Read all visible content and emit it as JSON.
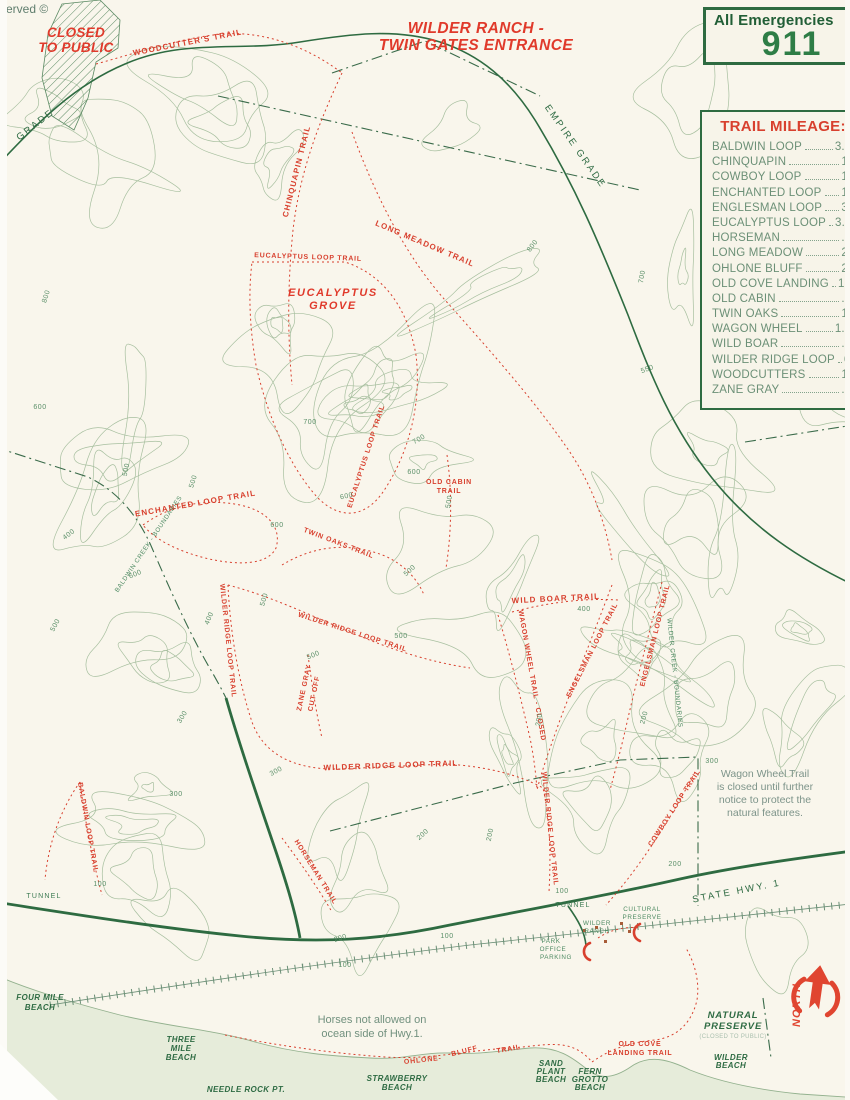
{
  "page": {
    "reserved": "served ©"
  },
  "title": {
    "line1": "WILDER RANCH -",
    "line2": "TWIN GATES ENTRANCE"
  },
  "closed_area": {
    "line1": "CLOSED",
    "line2": "TO PUBLIC"
  },
  "emergency": {
    "label": "All Emergencies",
    "number": "911"
  },
  "mileage": {
    "title": "TRAIL MILEAGE:",
    "entries": [
      {
        "name": "BALDWIN LOOP",
        "miles": "3.25"
      },
      {
        "name": "CHINQUAPIN",
        "miles": "1.2"
      },
      {
        "name": "COWBOY LOOP",
        "miles": "1.5"
      },
      {
        "name": "ENCHANTED LOOP",
        "miles": "1.5"
      },
      {
        "name": "ENGLESMAN LOOP",
        "miles": "3.0"
      },
      {
        "name": "EUCALYPTUS LOOP",
        "miles": "3.75"
      },
      {
        "name": "HORSEMAN",
        "miles": ".65"
      },
      {
        "name": "LONG MEADOW",
        "miles": "2.1"
      },
      {
        "name": "OHLONE BLUFF",
        "miles": "2.5"
      },
      {
        "name": "OLD COVE LANDING",
        "miles": "1.25"
      },
      {
        "name": "OLD CABIN",
        "miles": ".75"
      },
      {
        "name": "TWIN OAKS",
        "miles": "1.0"
      },
      {
        "name": "WAGON WHEEL",
        "miles": "1.75"
      },
      {
        "name": "WILD BOAR",
        "miles": ".25"
      },
      {
        "name": "WILDER RIDGE LOOP",
        "miles": "6.23"
      },
      {
        "name": "WOODCUTTERS",
        "miles": "1.9"
      },
      {
        "name": "ZANE GRAY",
        "miles": ".75"
      }
    ]
  },
  "notices": {
    "wagon": [
      "Wagon Wheel Trail",
      "is closed until further",
      "notice to protect the",
      "natural features."
    ],
    "horses": [
      "Horses not allowed on",
      "ocean side of Hwy.1."
    ]
  },
  "north_label": "NORTH",
  "colors": {
    "paper": "#f9f6ec",
    "ocean": "#e6ecda",
    "map_green": "#2e6b41",
    "trail_red": "#d8402e",
    "contour_green": "#a7bf9f",
    "mileage_text": "#6c9077"
  },
  "map": {
    "contours": {
      "seed": 11,
      "count": 58,
      "color": "#a7bf9f"
    },
    "labels": [
      {
        "t": "WOODCUTTER'S TRAIL",
        "x": 188,
        "y": 45,
        "r": -11,
        "c": "rt",
        "n": "label-woodcutters-trail"
      },
      {
        "t": "CHINQUAPIN TRAIL",
        "x": 299,
        "y": 172,
        "r": -76,
        "c": "rt",
        "n": "label-chinquapin-trail"
      },
      {
        "t": "LONG MEADOW TRAIL",
        "x": 424,
        "y": 246,
        "r": 23,
        "c": "rt",
        "n": "label-long-meadow-trail"
      },
      {
        "t": "EUCALYPTUS LOOP TRAIL",
        "x": 308,
        "y": 259,
        "r": 2,
        "c": "rt7",
        "n": "label-eucalyptus-loop-trail"
      },
      {
        "t": "EUCALYPTUS LOOP TRAIL",
        "x": 368,
        "y": 457,
        "r": -72,
        "c": "rt7",
        "n": "label-eucalyptus-loop-trail"
      },
      {
        "t": "OLD CABIN",
        "x": 449,
        "y": 484,
        "r": 0,
        "c": "rt7",
        "n": "label-old-cabin-trail"
      },
      {
        "t": "TRAIL",
        "x": 449,
        "y": 493,
        "r": 0,
        "c": "rt7",
        "n": "label-old-cabin-trail"
      },
      {
        "t": "ENCHANTED LOOP TRAIL",
        "x": 196,
        "y": 506,
        "r": -10,
        "c": "rt",
        "n": "label-enchanted-loop-trail"
      },
      {
        "t": "TWIN OAKS TRAIL",
        "x": 338,
        "y": 545,
        "r": 21,
        "c": "rt7",
        "n": "label-twin-oaks-trail"
      },
      {
        "t": "WILD BOAR TRAIL",
        "x": 556,
        "y": 601,
        "r": -3,
        "c": "rt",
        "n": "label-wild-boar-trail"
      },
      {
        "t": "WILDER RIDGE LOOP TRAIL",
        "x": 226,
        "y": 641,
        "r": 84,
        "c": "rt7",
        "n": "label-wilder-ridge-loop-trail"
      },
      {
        "t": "WILDER RIDGE LOOP TRAIL",
        "x": 352,
        "y": 634,
        "r": 18,
        "c": "rt7",
        "n": "label-wilder-ridge-loop-trail"
      },
      {
        "t": "ZANE GRAY",
        "x": 306,
        "y": 688,
        "r": -78,
        "c": "rt7",
        "n": "label-zane-gray-cutoff"
      },
      {
        "t": "CUT OFF",
        "x": 316,
        "y": 694,
        "r": -78,
        "c": "rt7",
        "n": "label-zane-gray-cutoff"
      },
      {
        "t": "WAGON WHEEL TRAIL - CLOSED",
        "x": 530,
        "y": 676,
        "r": 80,
        "c": "rt7",
        "n": "label-wagon-wheel-trail"
      },
      {
        "t": "ENGELSMAN LOOP TRAIL",
        "x": 594,
        "y": 651,
        "r": -63,
        "c": "rt7",
        "n": "label-engelsman-loop-trail"
      },
      {
        "t": "ENGELSMAN LOOP TRAIL",
        "x": 657,
        "y": 636,
        "r": -76,
        "c": "rt7",
        "n": "label-engelsman-loop-trail"
      },
      {
        "t": "WILDER RIDGE LOOP TRAIL",
        "x": 391,
        "y": 768,
        "r": -2,
        "c": "rt",
        "n": "label-wilder-ridge-loop-trail"
      },
      {
        "t": "WILDER RIDGE LOOP TRAIL",
        "x": 548,
        "y": 829,
        "r": 84,
        "c": "rt7",
        "n": "label-wilder-ridge-loop-trail"
      },
      {
        "t": "HORSEMAN TRAIL",
        "x": 314,
        "y": 873,
        "r": 58,
        "c": "rt7",
        "n": "label-horseman-trail"
      },
      {
        "t": "BALDWIN LOOP TRAIL",
        "x": 86,
        "y": 828,
        "r": 80,
        "c": "rt7",
        "n": "label-baldwin-loop-trail"
      },
      {
        "t": "COWBOY LOOP TRAIL",
        "x": 676,
        "y": 809,
        "r": -57,
        "c": "rt7",
        "n": "label-cowboy-loop-trail"
      },
      {
        "t": "OHLONE-",
        "x": 423,
        "y": 1062,
        "r": -6,
        "c": "rt7",
        "n": "label-ohlone-bluff-trail"
      },
      {
        "t": "BLUFF",
        "x": 465,
        "y": 1053,
        "r": -14,
        "c": "rt7",
        "n": "label-ohlone-bluff-trail"
      },
      {
        "t": "TRAIL",
        "x": 509,
        "y": 1051,
        "r": -10,
        "c": "rt7",
        "n": "label-ohlone-bluff-trail"
      },
      {
        "t": "OLD COVE",
        "x": 640,
        "y": 1046,
        "r": 0,
        "c": "rt7",
        "n": "label-old-cove-landing-trail"
      },
      {
        "t": "LANDING TRAIL",
        "x": 640,
        "y": 1055,
        "r": 0,
        "c": "rt7",
        "n": "label-old-cove-landing-trail"
      },
      {
        "t": "EUCALYPTUS",
        "x": 333,
        "y": 296,
        "r": 0,
        "c": "rg",
        "n": "label-eucalyptus-grove"
      },
      {
        "t": "GROVE",
        "x": 333,
        "y": 309,
        "r": 0,
        "c": "rg",
        "n": "label-eucalyptus-grove"
      },
      {
        "t": "GRADE",
        "x": 37,
        "y": 127,
        "r": -38,
        "c": "gl",
        "n": "label-grade-road"
      },
      {
        "t": "EMPIRE GRADE",
        "x": 573,
        "y": 148,
        "r": 55,
        "c": "gl",
        "n": "label-empire-grade-road"
      },
      {
        "t": "STATE HWY. 1",
        "x": 737,
        "y": 894,
        "r": -11,
        "c": "gl",
        "n": "label-state-hwy-1"
      },
      {
        "t": "TUNNEL",
        "x": 44,
        "y": 898,
        "r": 0,
        "c": "gs",
        "n": "label-tunnel"
      },
      {
        "t": "TUNNEL",
        "x": 573,
        "y": 907,
        "r": 0,
        "c": "gs",
        "n": "label-tunnel"
      },
      {
        "t": "WILDER",
        "x": 597,
        "y": 925,
        "r": 0,
        "c": "gs6",
        "n": "label-wilder-ranch"
      },
      {
        "t": "RANCH",
        "x": 597,
        "y": 933,
        "r": 0,
        "c": "gs6",
        "n": "label-wilder-ranch"
      },
      {
        "t": "CULTURAL",
        "x": 642,
        "y": 911,
        "r": 0,
        "c": "gs6",
        "n": "label-cultural-preserve"
      },
      {
        "t": "PRESERVE",
        "x": 642,
        "y": 919,
        "r": 0,
        "c": "gs6",
        "n": "label-cultural-preserve"
      },
      {
        "t": "PARK",
        "x": 551,
        "y": 943,
        "r": 0,
        "c": "gs6",
        "n": "label-park-office-parking"
      },
      {
        "t": "OFFICE",
        "x": 553,
        "y": 951,
        "r": 0,
        "c": "gs6",
        "n": "label-park-office-parking"
      },
      {
        "t": "PARKING",
        "x": 556,
        "y": 959,
        "r": 0,
        "c": "gs6",
        "n": "label-park-office-parking"
      },
      {
        "t": "BALDWIN CREEK - BOUNDARIES",
        "x": 150,
        "y": 545,
        "r": -56,
        "c": "gs6",
        "n": "label-baldwin-creek-boundary"
      },
      {
        "t": "WILDER CREEK - BOUNDARIES",
        "x": 673,
        "y": 673,
        "r": 84,
        "c": "gs6",
        "n": "label-wilder-creek-boundary"
      },
      {
        "t": "FOUR MILE",
        "x": 40,
        "y": 1000,
        "r": 0,
        "c": "bl",
        "n": "label-four-mile-beach"
      },
      {
        "t": "BEACH",
        "x": 40,
        "y": 1010,
        "r": 0,
        "c": "bl",
        "n": "label-four-mile-beach"
      },
      {
        "t": "THREE",
        "x": 181,
        "y": 1042,
        "r": 0,
        "c": "bl",
        "n": "label-three-mile-beach"
      },
      {
        "t": "MILE",
        "x": 181,
        "y": 1051,
        "r": 0,
        "c": "bl",
        "n": "label-three-mile-beach"
      },
      {
        "t": "BEACH",
        "x": 181,
        "y": 1060,
        "r": 0,
        "c": "bl",
        "n": "label-three-mile-beach"
      },
      {
        "t": "NEEDLE ROCK PT.",
        "x": 246,
        "y": 1092,
        "r": 0,
        "c": "bl",
        "n": "label-needle-rock-pt"
      },
      {
        "t": "STRAWBERRY",
        "x": 397,
        "y": 1081,
        "r": 0,
        "c": "bl",
        "n": "label-strawberry-beach"
      },
      {
        "t": "BEACH",
        "x": 397,
        "y": 1090,
        "r": 0,
        "c": "bl",
        "n": "label-strawberry-beach"
      },
      {
        "t": "SAND",
        "x": 551,
        "y": 1066,
        "r": 0,
        "c": "bl",
        "n": "label-sand-plant-beach"
      },
      {
        "t": "PLANT",
        "x": 551,
        "y": 1074,
        "r": 0,
        "c": "bl",
        "n": "label-sand-plant-beach"
      },
      {
        "t": "BEACH",
        "x": 551,
        "y": 1082,
        "r": 0,
        "c": "bl",
        "n": "label-sand-plant-beach"
      },
      {
        "t": "FERN",
        "x": 590,
        "y": 1074,
        "r": 0,
        "c": "bl",
        "n": "label-fern-grotto-beach"
      },
      {
        "t": "GROTTO",
        "x": 590,
        "y": 1082,
        "r": 0,
        "c": "bl",
        "n": "label-fern-grotto-beach"
      },
      {
        "t": "BEACH",
        "x": 590,
        "y": 1090,
        "r": 0,
        "c": "bl",
        "n": "label-fern-grotto-beach"
      },
      {
        "t": "WILDER",
        "x": 731,
        "y": 1060,
        "r": 0,
        "c": "bl",
        "n": "label-wilder-beach"
      },
      {
        "t": "BEACH",
        "x": 731,
        "y": 1068,
        "r": 0,
        "c": "bl",
        "n": "label-wilder-beach"
      },
      {
        "t": "NATURAL",
        "x": 733,
        "y": 1018,
        "r": 0,
        "c": "bl9",
        "n": "label-natural-preserve"
      },
      {
        "t": "PRESERVE",
        "x": 733,
        "y": 1029,
        "r": 0,
        "c": "bl9",
        "n": "label-natural-preserve"
      },
      {
        "t": "(CLOSED TO PUBLIC)",
        "x": 733,
        "y": 1038,
        "r": 0,
        "c": "sub",
        "n": "label-natural-preserve-closed"
      },
      {
        "t": "NORTH",
        "x": 800,
        "y": 1005,
        "r": -90,
        "c": "north",
        "n": "label-north"
      },
      {
        "t": "800",
        "x": 48,
        "y": 297,
        "r": -72,
        "c": "el",
        "n": "elevation-label"
      },
      {
        "t": "800",
        "x": 534,
        "y": 247,
        "r": -52,
        "c": "el",
        "n": "elevation-label"
      },
      {
        "t": "700",
        "x": 644,
        "y": 277,
        "r": -80,
        "c": "el",
        "n": "elevation-label"
      },
      {
        "t": "700",
        "x": 310,
        "y": 424,
        "r": 0,
        "c": "el",
        "n": "elevation-label"
      },
      {
        "t": "700",
        "x": 420,
        "y": 441,
        "r": -30,
        "c": "el",
        "n": "elevation-label"
      },
      {
        "t": "600",
        "x": 40,
        "y": 409,
        "r": 0,
        "c": "el",
        "n": "elevation-label"
      },
      {
        "t": "600",
        "x": 136,
        "y": 576,
        "r": -22,
        "c": "el",
        "n": "elevation-label"
      },
      {
        "t": "600",
        "x": 277,
        "y": 527,
        "r": 0,
        "c": "el",
        "n": "elevation-label"
      },
      {
        "t": "600",
        "x": 347,
        "y": 498,
        "r": -12,
        "c": "el",
        "n": "elevation-label"
      },
      {
        "t": "600",
        "x": 414,
        "y": 474,
        "r": 0,
        "c": "el",
        "n": "elevation-label"
      },
      {
        "t": "550",
        "x": 648,
        "y": 371,
        "r": -20,
        "c": "el",
        "n": "elevation-label"
      },
      {
        "t": "500",
        "x": 128,
        "y": 470,
        "r": -78,
        "c": "el",
        "n": "elevation-label"
      },
      {
        "t": "500",
        "x": 195,
        "y": 482,
        "r": -72,
        "c": "el",
        "n": "elevation-label"
      },
      {
        "t": "500",
        "x": 57,
        "y": 626,
        "r": -62,
        "c": "el",
        "n": "elevation-label"
      },
      {
        "t": "500",
        "x": 451,
        "y": 502,
        "r": -80,
        "c": "el",
        "n": "elevation-label"
      },
      {
        "t": "500",
        "x": 411,
        "y": 572,
        "r": -42,
        "c": "el",
        "n": "elevation-label"
      },
      {
        "t": "500",
        "x": 266,
        "y": 600,
        "r": -74,
        "c": "el",
        "n": "elevation-label"
      },
      {
        "t": "500",
        "x": 314,
        "y": 657,
        "r": -22,
        "c": "el",
        "n": "elevation-label"
      },
      {
        "t": "500",
        "x": 401,
        "y": 638,
        "r": 0,
        "c": "el",
        "n": "elevation-label"
      },
      {
        "t": "400",
        "x": 70,
        "y": 536,
        "r": -38,
        "c": "el",
        "n": "elevation-label"
      },
      {
        "t": "400",
        "x": 211,
        "y": 619,
        "r": -68,
        "c": "el",
        "n": "elevation-label"
      },
      {
        "t": "400",
        "x": 584,
        "y": 611,
        "r": 0,
        "c": "el",
        "n": "elevation-label"
      },
      {
        "t": "300",
        "x": 184,
        "y": 718,
        "r": -58,
        "c": "el",
        "n": "elevation-label"
      },
      {
        "t": "300",
        "x": 277,
        "y": 773,
        "r": -28,
        "c": "el",
        "n": "elevation-label"
      },
      {
        "t": "300",
        "x": 176,
        "y": 796,
        "r": 0,
        "c": "el",
        "n": "elevation-label"
      },
      {
        "t": "300",
        "x": 712,
        "y": 763,
        "r": 0,
        "c": "el",
        "n": "elevation-label"
      },
      {
        "t": "200",
        "x": 424,
        "y": 836,
        "r": -42,
        "c": "el",
        "n": "elevation-label"
      },
      {
        "t": "200",
        "x": 492,
        "y": 835,
        "r": -78,
        "c": "el",
        "n": "elevation-label"
      },
      {
        "t": "200",
        "x": 675,
        "y": 866,
        "r": 0,
        "c": "el",
        "n": "elevation-label"
      },
      {
        "t": "200",
        "x": 646,
        "y": 718,
        "r": -75,
        "c": "el",
        "n": "elevation-label"
      },
      {
        "t": "200",
        "x": 541,
        "y": 720,
        "r": -80,
        "c": "el",
        "n": "elevation-label"
      },
      {
        "t": "200",
        "x": 341,
        "y": 940,
        "r": -18,
        "c": "el",
        "n": "elevation-label"
      },
      {
        "t": "100",
        "x": 345,
        "y": 967,
        "r": 0,
        "c": "el",
        "n": "elevation-label"
      },
      {
        "t": "100",
        "x": 447,
        "y": 938,
        "r": 0,
        "c": "el",
        "n": "elevation-label"
      },
      {
        "t": "100",
        "x": 100,
        "y": 886,
        "r": 0,
        "c": "el",
        "n": "elevation-label"
      },
      {
        "t": "100",
        "x": 562,
        "y": 893,
        "r": 0,
        "c": "el",
        "n": "elevation-label"
      }
    ]
  }
}
